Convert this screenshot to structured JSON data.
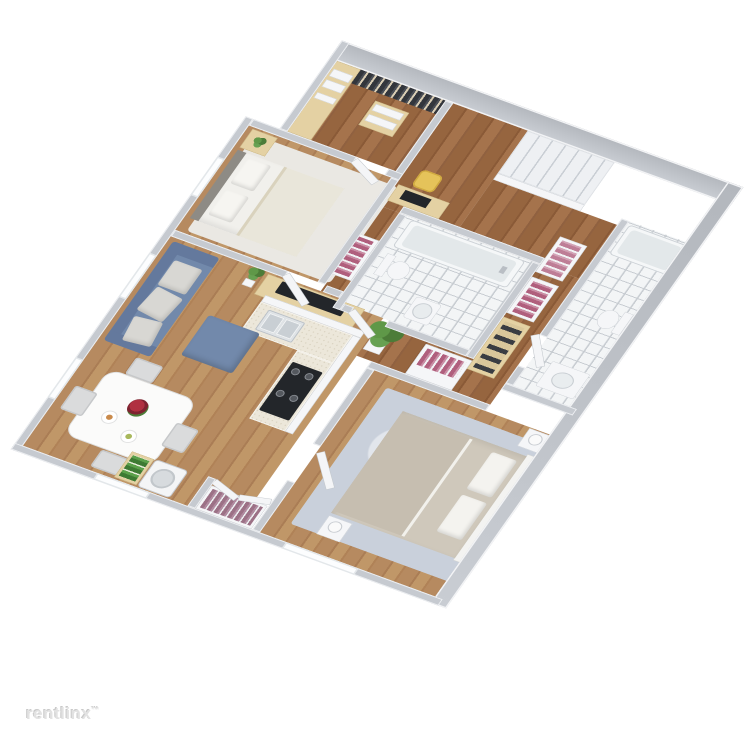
{
  "watermark": {
    "text": "rentlinx",
    "symbol": "™",
    "color": "#e2e2e2"
  },
  "scene": {
    "type": "3d-isometric-floorplan-render",
    "background": "#ffffff",
    "description": "Two-bedroom / two-bathroom apartment 3D floor plan, viewed from above at an angle"
  },
  "palette": {
    "wall_gray": "#c6cad0",
    "wall_top_white": "#f2f3f5",
    "hall_wood": "#96653f",
    "room_wood": "#b68a60",
    "tile_white": "#f3f5f6",
    "sofa_blue": "#7289ab",
    "closet_clothes_pink": "#b05f7d",
    "closet_clothes_dark": "#33363c",
    "light_wood_furniture": "#e4d1a3",
    "bed2_duvet_taupe": "#cfc8bb",
    "plant_green": "#4c7c38",
    "accent_chair_yellow": "#e5c35a"
  },
  "rooms": [
    {
      "name": "walk-in-closet",
      "items": [
        "wood shelving with folded linens",
        "rail of dark hanging clothes",
        "corner shelf stack",
        "open door"
      ]
    },
    {
      "name": "bedroom-1",
      "items": [
        "double bed with white bedding",
        "gray headboard",
        "two pillows",
        "nightstand with plant",
        "white area rug",
        "desk with monitor",
        "yellow chair",
        "window"
      ]
    },
    {
      "name": "bathroom-1",
      "items": [
        "bathtub",
        "toilet",
        "pedestal sink",
        "white tile floor",
        "open door",
        "flanking wardrobe with pink clothes (left)",
        "flanking wardrobe with pink clothes (right)"
      ]
    },
    {
      "name": "staircase",
      "items": [
        "white steps",
        "banister"
      ]
    },
    {
      "name": "hallway",
      "items": [
        "wood flooring",
        "linen closet with pink and white clothes",
        "shoe shelving with dark shoes"
      ]
    },
    {
      "name": "bathroom-2",
      "items": [
        "bathtub",
        "toilet",
        "vanity sink",
        "white tile floor",
        "open door"
      ]
    },
    {
      "name": "bedroom-2",
      "items": [
        "double bed with taupe duvet",
        "white pillows",
        "white headboard",
        "mottled blue-gray rug",
        "two nightstands with lamps",
        "wardrobe with pink clothes",
        "open door",
        "window"
      ]
    },
    {
      "name": "kitchen",
      "items": [
        "L-shaped speckled counter",
        "double-basin sink",
        "black cooktop with four burners",
        "large potted plant",
        "white half walls"
      ]
    },
    {
      "name": "living-room",
      "items": [
        "blue three-seat sofa",
        "three gray throw pillows",
        "blue ottoman",
        "light wood TV console",
        "flat-screen TV",
        "potted plant",
        "windows"
      ]
    },
    {
      "name": "dining-area",
      "items": [
        "white dining table",
        "red flower centerpiece",
        "plates with food",
        "four gray chairs",
        "window"
      ]
    },
    {
      "name": "laundry-entry",
      "items": [
        "washing machine",
        "shelf with green plants",
        "entry closet with mauve clothes",
        "open double doors"
      ]
    }
  ]
}
